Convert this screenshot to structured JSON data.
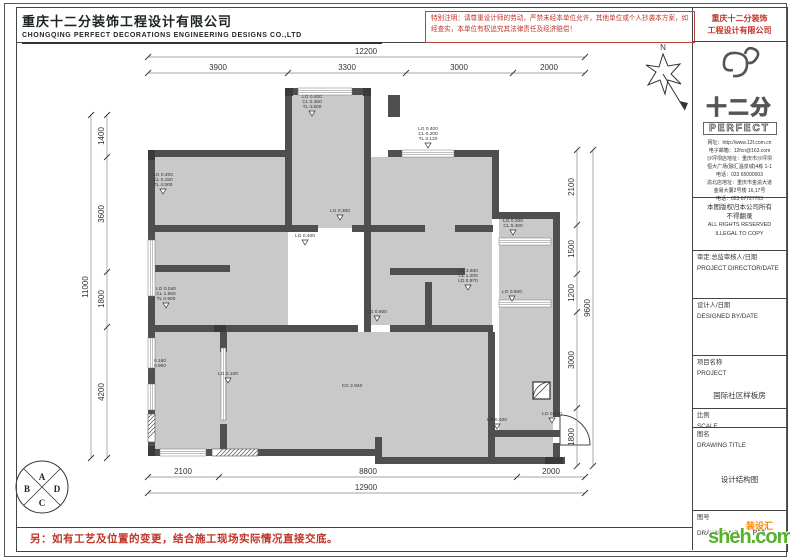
{
  "header": {
    "company_cn": "重庆十二分装饰工程设计有限公司",
    "company_en": "CHONGQING PERFECT DECORATIONS ENGINEERING DESIGNS CO.,LTD"
  },
  "notice": {
    "text": "特别注明：请尊重设计师的劳动，严禁未经本单位允许，其他单位或个人抄袭本方案，如经查实，本单位有权追究其法律责任及经济赔偿！",
    "company_line1": "重庆十二分装饰",
    "company_line2": "工程设计有限公司"
  },
  "titleblock": {
    "brand_cn": "十二分",
    "brand_en": "PERFECT",
    "contact_lines": [
      "网址：http://www.12f.com.cn",
      "电子邮箱：12fcn@163.com",
      "沙坪坝店地址：重庆市沙坪坝",
      "恒大广场(融汇温泉城)4栋 1-1",
      "电话：023 65000003",
      "渝北店地址：重庆市金渝大道",
      "金易大厦2号楼 16,17号",
      "电话：023 67727703"
    ],
    "copyright_cn1": "本图版权归本公司所有",
    "copyright_cn2": "不得翻录",
    "copyright_en1": "ALL RIGHTS RESERVED",
    "copyright_en2": "ILLEGAL TO COPY",
    "director_cn": "审定:总监审核人/日期",
    "director_en": "PROJECT DIRECTOR/DATE",
    "designer_cn": "设计人/日期",
    "designer_en": "DESIGNED BY/DATE",
    "project_cn": "项目名称",
    "project_en": "PROJECT",
    "project_name": "国际社区样板房",
    "scale_cn": "比例",
    "scale_en": "SCALE",
    "title_cn": "图名",
    "title_en": "DRAWING TITLE",
    "drawing_title": "设计结构图",
    "no_cn": "图号",
    "no_en": "DRAWING NO.",
    "drawing_no": "P06"
  },
  "plan": {
    "north_label": "N",
    "compass_letters": [
      "A",
      "B",
      "C",
      "D"
    ],
    "levels": [
      {
        "lines": [
          "LG 0.400",
          "CL 0.450",
          "TL 4.500"
        ],
        "tri": true
      },
      {
        "lines": [
          "LG 0.400",
          "CL 0.150",
          "TL 4.500"
        ],
        "tri": true
      },
      {
        "lines": [
          "LG 0.040",
          "CL 1.650",
          "TL 0.900"
        ],
        "tri": true
      },
      {
        "lines": [
          "LG 0.300"
        ],
        "tri": true
      },
      {
        "lines": [
          "LG 0.400"
        ],
        "tri": true
      },
      {
        "lines": [
          "LG 0.400",
          "CL 0.200",
          "TL 3.120"
        ],
        "tri": true
      },
      {
        "lines": [
          "LG 0.200",
          "CL 0.400"
        ],
        "tri": true
      },
      {
        "lines": [
          "LG 3.600",
          "CL 1.200",
          "LD 0.970"
        ],
        "tri": true
      },
      {
        "lines": [
          "LG 0.800"
        ],
        "tri": true
      },
      {
        "lines": [
          "LG 0.600"
        ],
        "tri": true
      },
      {
        "lines": [
          "LG 0.100"
        ],
        "tri": true
      },
      {
        "lines": [
          "CG 2.940"
        ],
        "tri": false
      },
      {
        "lines": [
          "LG 0.400"
        ],
        "tri": true
      },
      {
        "lines": [
          "LG 0.020"
        ],
        "tri": true
      },
      {
        "lines": [
          "0.160",
          "0.900"
        ],
        "tri": false
      }
    ]
  },
  "dims": {
    "top_total": "12200",
    "top_segments": [
      "3900",
      "3300",
      "3000",
      "2000"
    ],
    "left_total": "11000",
    "left_segments": [
      "1400",
      "3600",
      "1800",
      "4200"
    ],
    "right_total": "9600",
    "right_segments": [
      "2100",
      "1500",
      "1200",
      "3000",
      "1800"
    ],
    "bottom_segments": [
      "2100",
      "8800",
      "2000"
    ],
    "bottom_total": "12900"
  },
  "footer": {
    "note": "另：如有工艺及位置的变更，结合施工现场实际情况直接交底。"
  },
  "watermark": {
    "cn": "装设汇",
    "domain": "sheh.com"
  },
  "colors": {
    "wall": "#4f4f4f",
    "column": "#3a3a3a",
    "room_fill": "#c9c9c9",
    "dimline": "#888",
    "dimtext": "#333",
    "red": "#c03328"
  }
}
